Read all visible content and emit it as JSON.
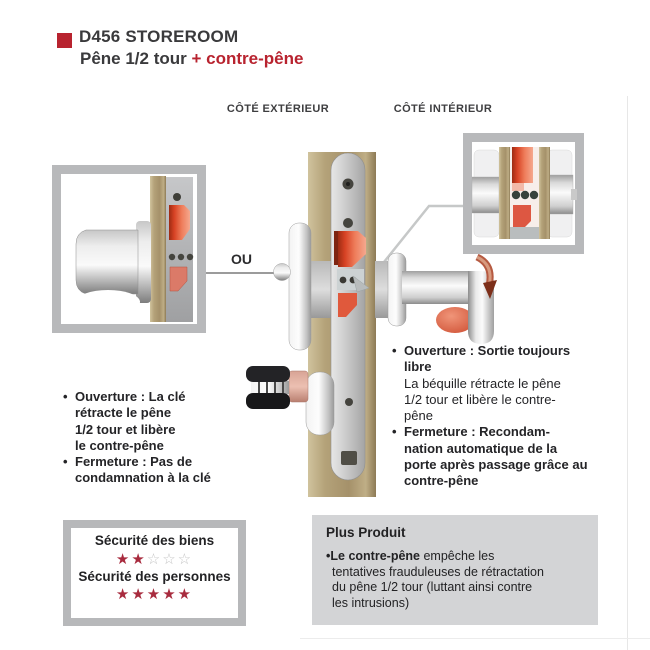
{
  "header": {
    "title": "D456 STOREROOM",
    "subtitle_dark": "Pêne 1/2 tour ",
    "subtitle_red": "+ contre-pêne"
  },
  "side_labels": {
    "exterior": "CÔTÉ EXTÉRIEUR",
    "interior": "CÔTÉ INTÉRIEUR",
    "or_label": "OU"
  },
  "left_notes": {
    "items": [
      {
        "lines": [
          "Ouverture : La clé",
          "rétracte le pêne",
          "1/2 tour et libère",
          "le contre-pêne"
        ]
      },
      {
        "lines": [
          "Fermeture : Pas de",
          "condamnation à la clé"
        ]
      }
    ]
  },
  "right_notes": {
    "items": [
      {
        "bold_lines": [
          "Ouverture : Sortie toujours",
          "libre"
        ],
        "regular_lines": [
          "La béquille rétracte le pêne",
          "1/2 tour et libère le contre-",
          "pêne"
        ]
      },
      {
        "bold_lines": [
          "Fermeture : Recondam-",
          "nation automatique de la",
          "porte après passage grâce au",
          "contre-pêne"
        ],
        "regular_lines": []
      }
    ]
  },
  "security_box": {
    "ratings": [
      {
        "label": "Sécurité des biens",
        "filled": 2,
        "total": 5
      },
      {
        "label": "Sécurité des personnes",
        "filled": 5,
        "total": 5
      }
    ]
  },
  "plus_box": {
    "title": "Plus Produit",
    "line1_bold": "Le contre-pêne",
    "line1_rest": " empêche les",
    "lines_rest": [
      "tentatives frauduleuses de rétractation",
      "du pêne 1/2 tour (luttant ainsi contre",
      "les intrusions)"
    ]
  },
  "colors": {
    "accent_red": "#b8232f",
    "text_dark": "#3a3a3c",
    "note_text": "#242427",
    "plus_bg": "#d3d4d6",
    "box_border": "#b7b8ba",
    "star_red": "#a82b3e",
    "star_empty": "#c6c6c6",
    "latch_red": "#dd4a2a",
    "wood_tan": "#ab9770"
  }
}
